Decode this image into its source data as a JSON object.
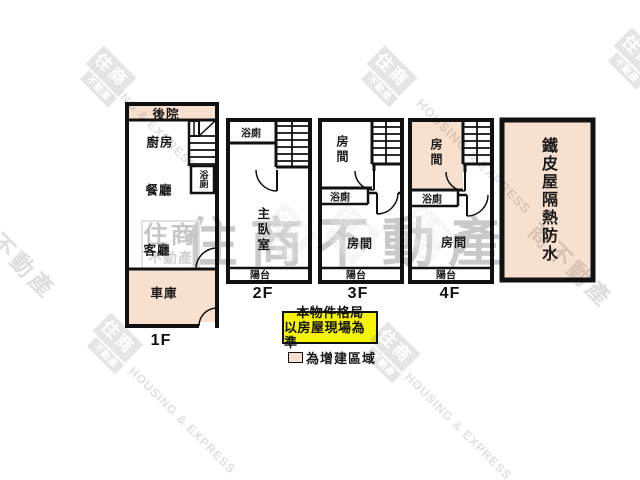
{
  "plan": {
    "floor1": {
      "label": "1F",
      "backyard": "後院",
      "kitchen": "廚房",
      "dining_room": "餐廳",
      "living_room": "客廳",
      "garage": "車庫",
      "bathroom": "浴廁"
    },
    "floor2": {
      "label": "2F",
      "bathroom": "浴廁",
      "master_bedroom": "主臥室",
      "balcony": "陽台"
    },
    "floor3": {
      "label": "3F",
      "room_upper": "房間",
      "bathroom": "浴廁",
      "room_lower": "房間",
      "balcony": "陽台"
    },
    "floor4": {
      "label": "4F",
      "room_upper": "房間",
      "bathroom": "浴廁",
      "room_lower": "房間",
      "balcony": "陽台"
    },
    "roof_area": {
      "label": "鐵皮屋隔熱防水"
    }
  },
  "notice": {
    "line1": "本物件格局",
    "line2": "以房屋現場為準"
  },
  "legend": {
    "label": "為增建區域"
  },
  "watermarks": {
    "brand": "住商不動產",
    "logo_main": "住商",
    "logo_sub": "不動產",
    "english": "HOUSING & EXPRESS",
    "side_left": "住商不動產",
    "side_right": "商不動產"
  },
  "colors": {
    "addition_fill": "#f8e0cf",
    "notice_bg": "#f7f402",
    "wall": "#111111",
    "watermark_gray": "#c9c9c9"
  }
}
